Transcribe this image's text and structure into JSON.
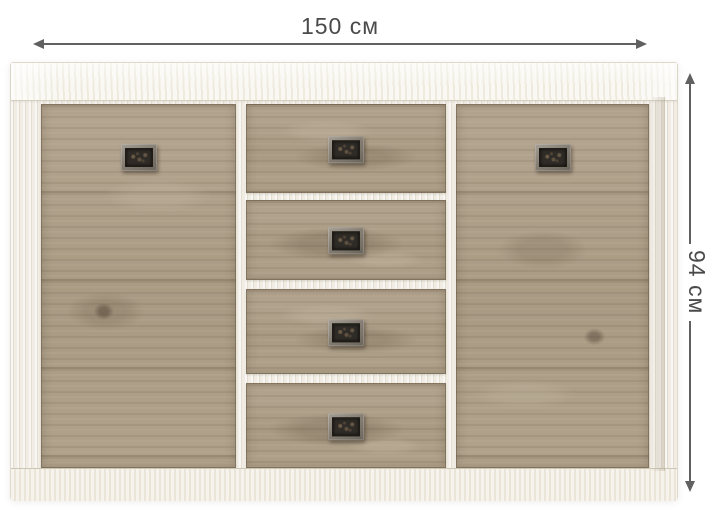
{
  "dimensions": {
    "width": {
      "label": "150 см",
      "value": 150,
      "unit": "см"
    },
    "height": {
      "label": "94 см",
      "value": 94,
      "unit": "см"
    }
  },
  "furniture": {
    "drawer_count": 4,
    "door_count": 2,
    "handle_icon": "antique-rectangular-plate-handle",
    "arrow_icons": [
      "arrow-left-icon",
      "arrow-right-icon",
      "arrow-up-icon",
      "arrow-down-icon"
    ]
  },
  "colors": {
    "background": "#ffffff",
    "frame_wood": "#f1ede4",
    "panel_wood": "#ada089",
    "panel_wood_dark": "#8c7f6b",
    "panel_wood_light": "#c3b6a2",
    "handle_plate": "#857f75",
    "handle_inset": "#2f2b26",
    "dimension_line": "#616161",
    "dimension_text": "#4a4a4a"
  }
}
